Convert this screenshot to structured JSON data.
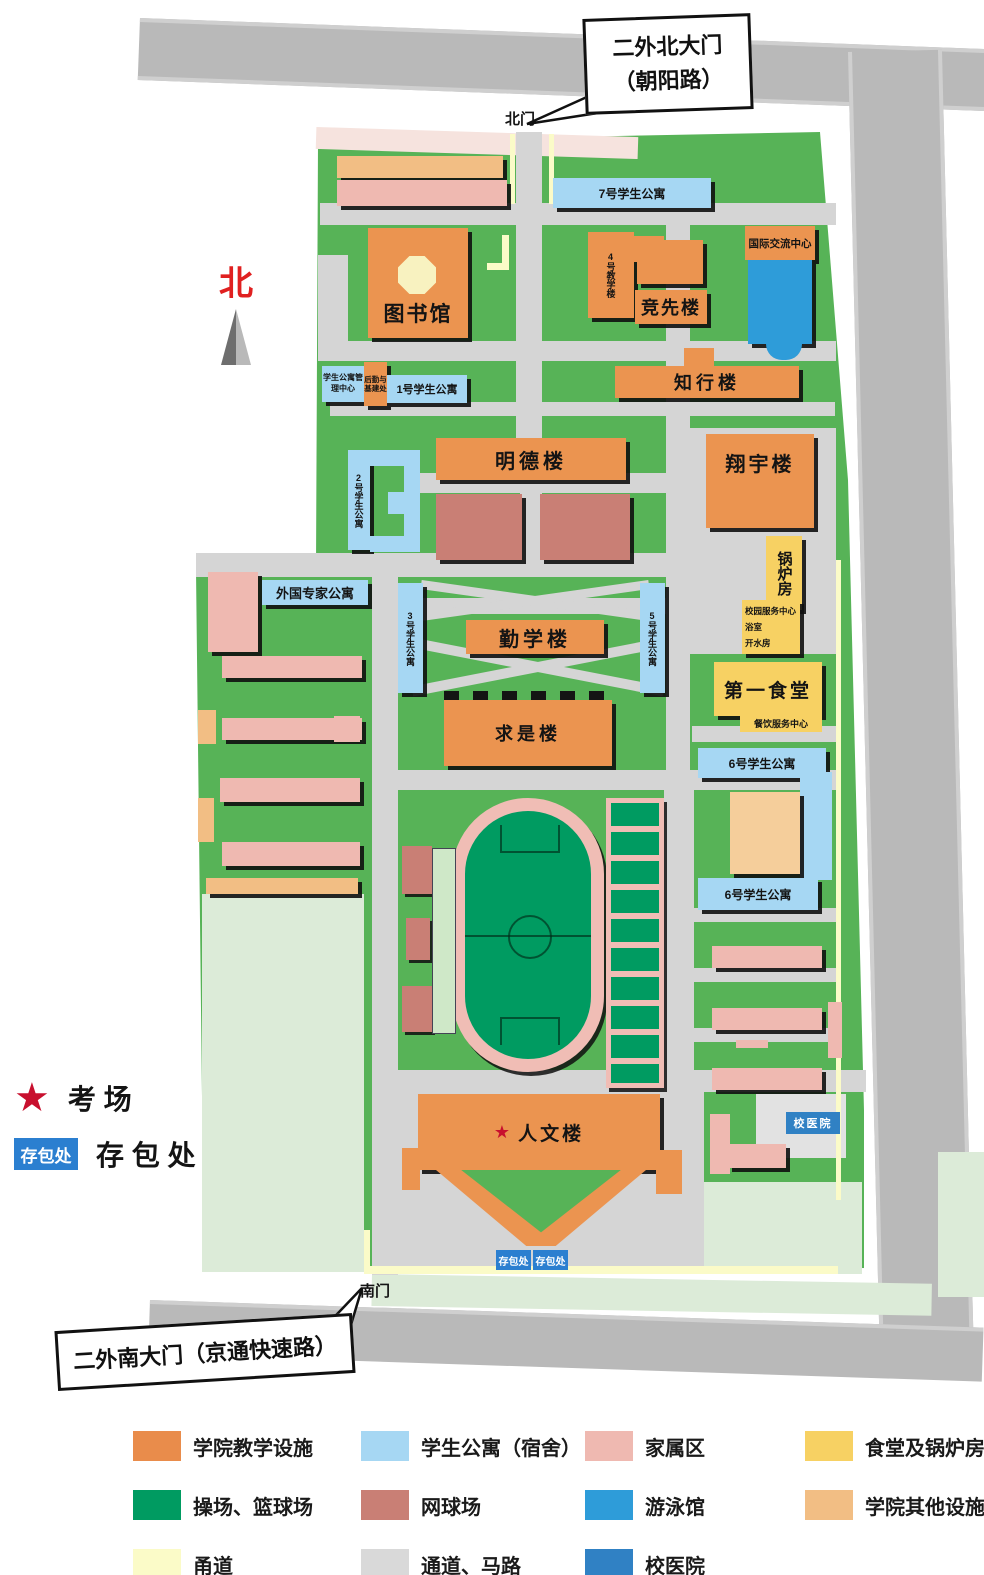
{
  "callouts": {
    "north_line1": "二外北大门",
    "north_line2": "（朝阳路）",
    "south_text": "二外南大门（京通快速路）"
  },
  "gates": {
    "north": "北门",
    "south": "南门"
  },
  "compass": {
    "label": "北"
  },
  "b": {
    "dorm7": "7号学生公寓",
    "library": "图书馆",
    "teach4": "4号教学楼",
    "jingxian": "竞先楼",
    "intl": "国际交流中心",
    "zhixing": "知行楼",
    "mgmt": "学生公寓管理中心",
    "logistics": "后勤与基建处",
    "dorm1": "1号学生公寓",
    "mingde": "明德楼",
    "xiangyu": "翔宇楼",
    "dorm2": "2号学生公寓",
    "boiler": "锅炉房",
    "svc_center": "校园服务中心",
    "svc_bath": "浴室",
    "svc_water": "开水房",
    "foreign": "外国专家公寓",
    "dorm3": "3号学生公寓",
    "qinxue": "勤学楼",
    "dorm5": "5号学生公寓",
    "canteen": "第一食堂",
    "catering": "餐饮服务中心",
    "qiushi": "求是楼",
    "dorm6_upper": "6号学生公寓",
    "dorm6_lower": "6号学生公寓",
    "hospital": "校医院",
    "renwen": "人文楼",
    "renwen_star": "★",
    "baggage_a": "存包处",
    "baggage_b": "存包处"
  },
  "key": {
    "exam_star": "★",
    "exam_label": "考 场",
    "baggage_badge": "存包处",
    "baggage_label": "存 包 处"
  },
  "legend": {
    "items": [
      {
        "label": "学院教学设施",
        "color": "#E98C4B"
      },
      {
        "label": "学生公寓（宿舍）",
        "color": "#A6D7F3"
      },
      {
        "label": "家属区",
        "color": "#EFB9B1"
      },
      {
        "label": "食堂及锅炉房",
        "color": "#F7D163"
      },
      {
        "label": "操场、篮球场",
        "color": "#009B61"
      },
      {
        "label": "网球场",
        "color": "#C97F75"
      },
      {
        "label": "游泳馆",
        "color": "#2E9CD9"
      },
      {
        "label": "学院其他设施",
        "color": "#F2BE84"
      },
      {
        "label": "甬道",
        "color": "#FBFBC8"
      },
      {
        "label": "通道、马路",
        "color": "#D9D9D9"
      },
      {
        "label": "校医院",
        "color": "#3081C4"
      }
    ]
  }
}
